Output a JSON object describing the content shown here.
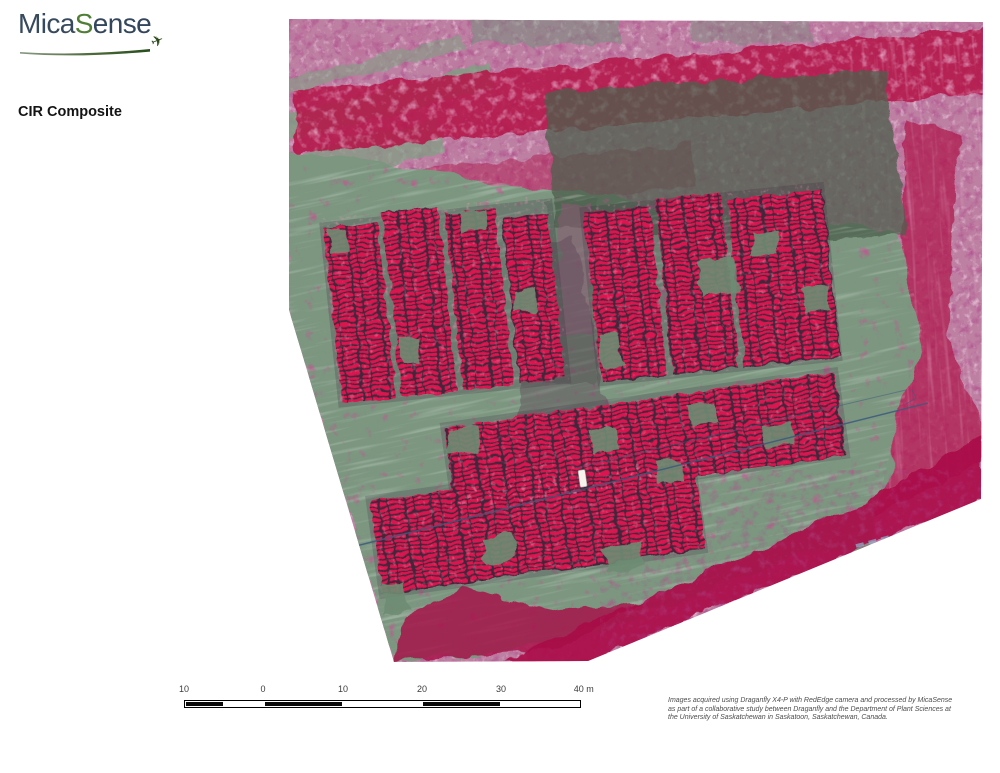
{
  "logo": {
    "part1": "Mica",
    "part2": "S",
    "part3": "ense",
    "plane_icon": "airplane",
    "color_navy": "#36495d",
    "color_green": "#4f7f35"
  },
  "title": "CIR Composite",
  "map": {
    "kind": "CIR composite aerial orthomosaic of crop trial plots",
    "colors": {
      "crop_vegetation_red": "#d81650",
      "field_green": "#7b9680",
      "bare_soil_pink": "#bd7fa2",
      "dense_vegetation_crimson": "#b41349",
      "path_line_blue": "#3b5a7d"
    }
  },
  "scalebar": {
    "unit": "m",
    "labels": [
      "10",
      "0",
      "10",
      "20",
      "30",
      "40 m"
    ],
    "segments": [
      {
        "width": 39,
        "fill": "black"
      },
      {
        "width": 40,
        "fill": "white"
      },
      {
        "width": 79,
        "fill": "black"
      },
      {
        "width": 79,
        "fill": "white"
      },
      {
        "width": 79,
        "fill": "black"
      },
      {
        "width": 79,
        "fill": "white"
      }
    ]
  },
  "attribution": {
    "line1": "Images acquired using Draganfly X4-P with RedEdge camera and processed by MicaSense",
    "line2": "as part of a collaborative study between Draganfly and the Department of Plant Sciences at",
    "line3": "the University of Saskatchewan in Saskatoon, Saskatchewan, Canada."
  }
}
